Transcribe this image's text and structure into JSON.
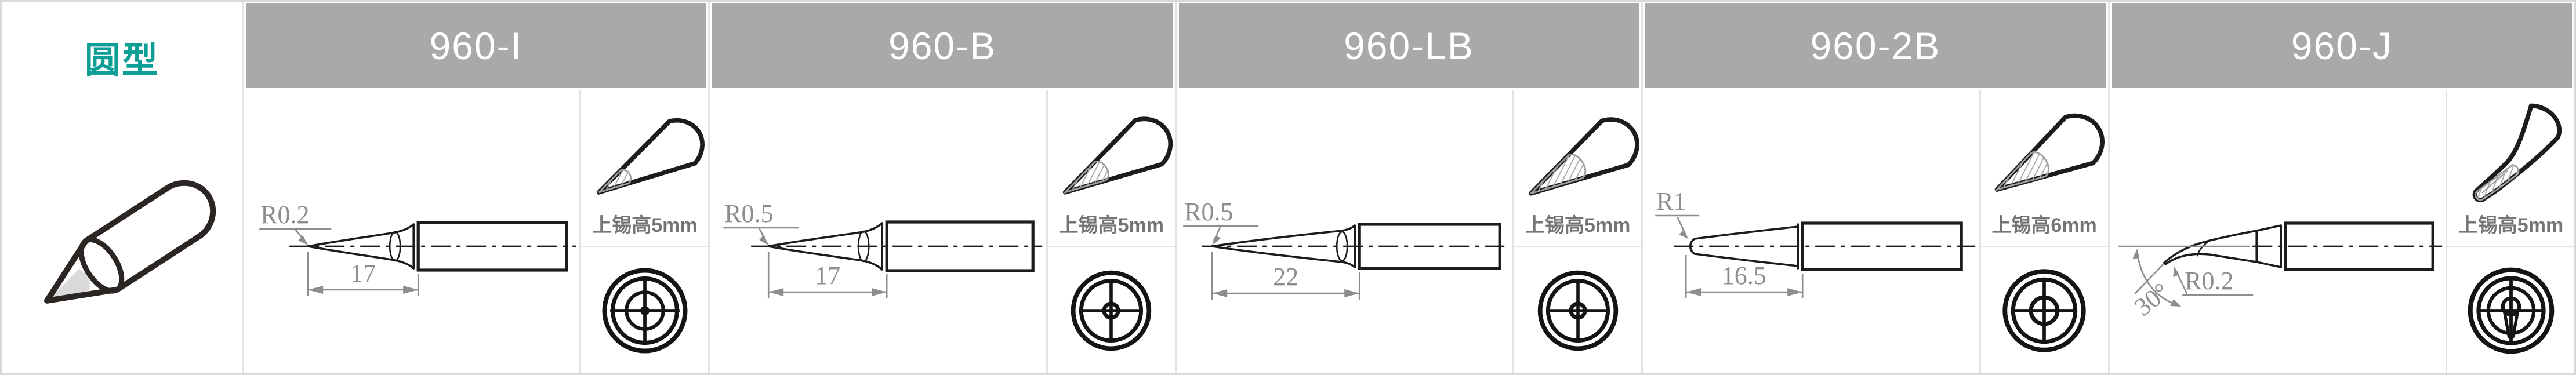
{
  "category": {
    "label": "圆型"
  },
  "columns": [
    {
      "model": "960-I",
      "radius_label": "R0.2",
      "length_label": "17",
      "tin_height_label": "上锡高5mm"
    },
    {
      "model": "960-B",
      "radius_label": "R0.5",
      "length_label": "17",
      "tin_height_label": "上锡高5mm"
    },
    {
      "model": "960-LB",
      "radius_label": "R0.5",
      "length_label": "22",
      "tin_height_label": "上锡高5mm"
    },
    {
      "model": "960-2B",
      "radius_label": "R1",
      "length_label": "16.5",
      "tin_height_label": "上锡高6mm"
    },
    {
      "model": "960-J",
      "radius_label": "R0.2",
      "angle_label": "30°",
      "tin_height_label": "上锡高5mm"
    }
  ],
  "colors": {
    "accent_teal": "#0d9f96",
    "header_bg": "#a9a9a9",
    "header_text": "#ffffff",
    "grid_line": "#e3e3e3",
    "drawing_line": "#1c1c1c",
    "dimension_gray": "#8d8d8d",
    "tin_text_gray": "#757575"
  }
}
